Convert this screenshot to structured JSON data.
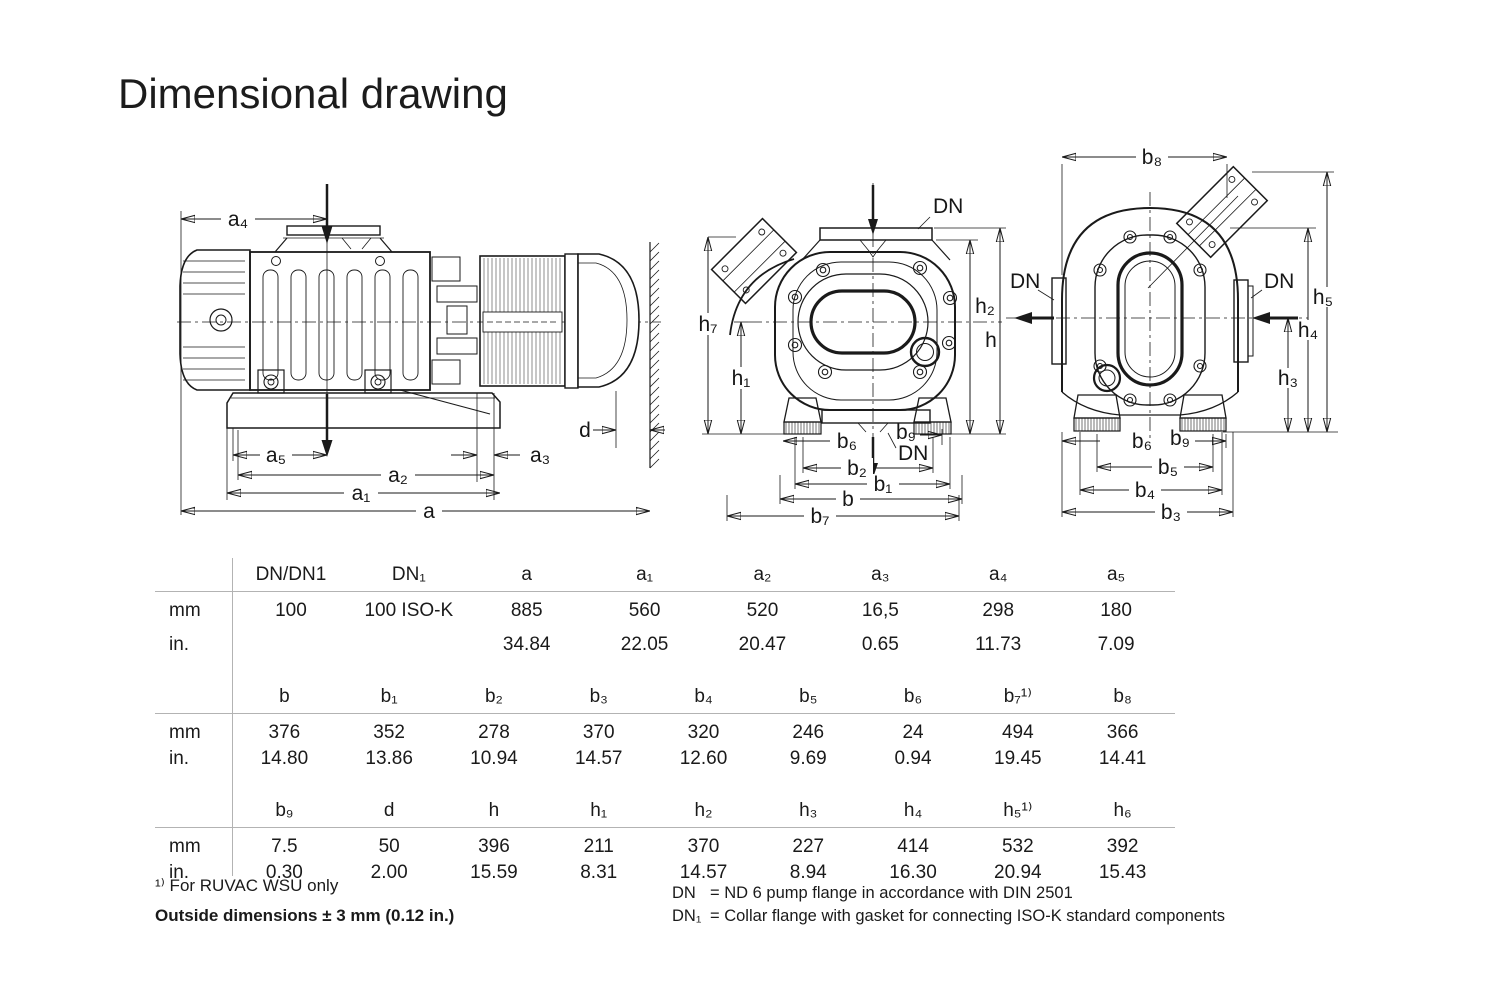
{
  "page": {
    "title": "Dimensional drawing"
  },
  "colors": {
    "ink": "#1a1a1a",
    "rule": "#b3b3b3"
  },
  "drawings": {
    "side": {
      "a4": "a₄",
      "a5": "a₅",
      "a3": "a₃",
      "a2": "a₂",
      "a1": "a₁",
      "a": "a",
      "d": "d"
    },
    "front": {
      "dn_top": "DN",
      "dn_bottom": "DN",
      "h7": "h₇",
      "h1": "h₁",
      "h2": "h₂",
      "h": "h",
      "b6": "b₆",
      "b9": "b₉",
      "b2": "b₂",
      "b1": "b₁",
      "b": "b",
      "b7": "b₇"
    },
    "end": {
      "b8": "b₈",
      "dn_left": "DN",
      "dn_right": "DN",
      "h5": "h₅",
      "h4": "h₄",
      "h3": "h₃",
      "b6": "b₆",
      "b9": "b₉",
      "b5": "b₅",
      "b4": "b₄",
      "b3": "b₃"
    }
  },
  "table": {
    "unit_labels": {
      "mm": "mm",
      "in": "in."
    },
    "sections": [
      {
        "headers": [
          "DN/DN1",
          "DN₁",
          "a",
          "a₁",
          "a₂",
          "a₃",
          "a₄",
          "a₅"
        ],
        "mm": [
          "100",
          "100 ISO-K",
          "885",
          "560",
          "520",
          "16,5",
          "298",
          "180"
        ],
        "in": [
          "",
          "",
          "34.84",
          "22.05",
          "20.47",
          "0.65",
          "11.73",
          "7.09"
        ]
      },
      {
        "headers": [
          "b",
          "b₁",
          "b₂",
          "b₃",
          "b₄",
          "b₅",
          "b₆",
          "b₇¹⁾",
          "b₈"
        ],
        "mm": [
          "376",
          "352",
          "278",
          "370",
          "320",
          "246",
          "24",
          "494",
          "366"
        ],
        "in": [
          "14.80",
          "13.86",
          "10.94",
          "14.57",
          "12.60",
          "9.69",
          "0.94",
          "19.45",
          "14.41"
        ]
      },
      {
        "headers": [
          "b₉",
          "d",
          "h",
          "h₁",
          "h₂",
          "h₃",
          "h₄",
          "h₅¹⁾",
          "h₆"
        ],
        "mm": [
          "7.5",
          "50",
          "396",
          "211",
          "370",
          "227",
          "414",
          "532",
          "392"
        ],
        "in": [
          "0.30",
          "2.00",
          "15.59",
          "8.31",
          "14.57",
          "8.94",
          "16.30",
          "20.94",
          "15.43"
        ]
      }
    ]
  },
  "footnotes": {
    "note1": "¹⁾ For RUVAC WSU only",
    "note2": "Outside dimensions ± 3 mm (0.12 in.)",
    "dn_legend": [
      {
        "term": "DN",
        "definition": "= ND 6 pump flange in accordance with DIN 2501"
      },
      {
        "term": "DN₁",
        "definition": "= Collar flange with gasket for connecting ISO-K standard components"
      }
    ]
  }
}
